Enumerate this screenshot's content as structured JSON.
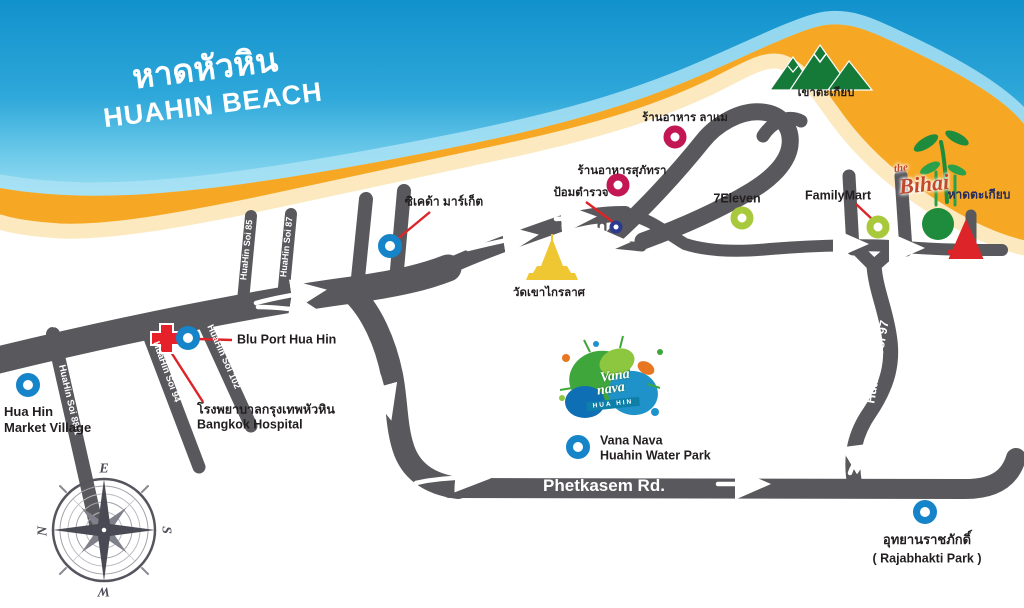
{
  "map": {
    "title_th": "หาดหัวหิน",
    "title_en": "HUAHIN BEACH",
    "roads": {
      "phetkasem_upper": "Phetkasem Rd.",
      "phetkasem_lower": "Phetkasem Rd.",
      "flyover": "FLYOVER",
      "soi85": "HuaHin Soi 85",
      "soi87": "HuaHin Soi 87",
      "soi88_1": "HuaHin Soi 88/1",
      "soi94": "HuaHin Soi 94",
      "soi102": "HuaHin Soi 102",
      "soi97": "HuaHin Soi 97"
    },
    "places": {
      "market_village_1": "Hua Hin",
      "market_village_2": "Market Village",
      "bluport": "Blu Port Hua Hin",
      "hospital_th": "โรงพยาบาลกรุงเทพหัวหิน",
      "hospital_en": "Bangkok Hospital",
      "cicada": "ซิเคด้า มาร์เก็ต",
      "temple": "วัดเขาไกรลาศ",
      "police": "ป้อมตำรวจ",
      "supatra": "ร้านอาหารสุภัทรา",
      "lamer": "ร้านอาหาร ลาแม",
      "seven_eleven": "7Eleven",
      "familymart": "FamilyMart",
      "khao_takiab": "เขาตะเกียบ",
      "hat_takiab": "หาดตะเกียบ",
      "vananava_1": "Vana Nava",
      "vananava_2": "Huahin Water Park",
      "rajabhakti_th": "อุทยานราชภักดิ์",
      "rajabhakti_en": "( Rajabhakti Park )"
    },
    "logos": {
      "bihai_the": "the",
      "bihai_name": "Bihai",
      "vana_line1": "Vana",
      "vana_line2": "nava",
      "vana_sub": "HUA HIN"
    },
    "compass": {
      "e": "E",
      "s": "S",
      "w": "W",
      "n": "N"
    },
    "colors": {
      "ocean_top": "#1191CC",
      "ocean_shore": "#9ADDF2",
      "sand": "#F6A825",
      "road": "#59585C",
      "marker_blue": "#1684C8",
      "marker_pink": "#C21753",
      "marker_lime": "#A9C93D",
      "marker_police": "#2B3A8F",
      "accent_red": "#DD2428",
      "mountain_green": "#157A38",
      "temple_gold": "#EFC733",
      "bihai_green": "#1E8C3C"
    }
  }
}
